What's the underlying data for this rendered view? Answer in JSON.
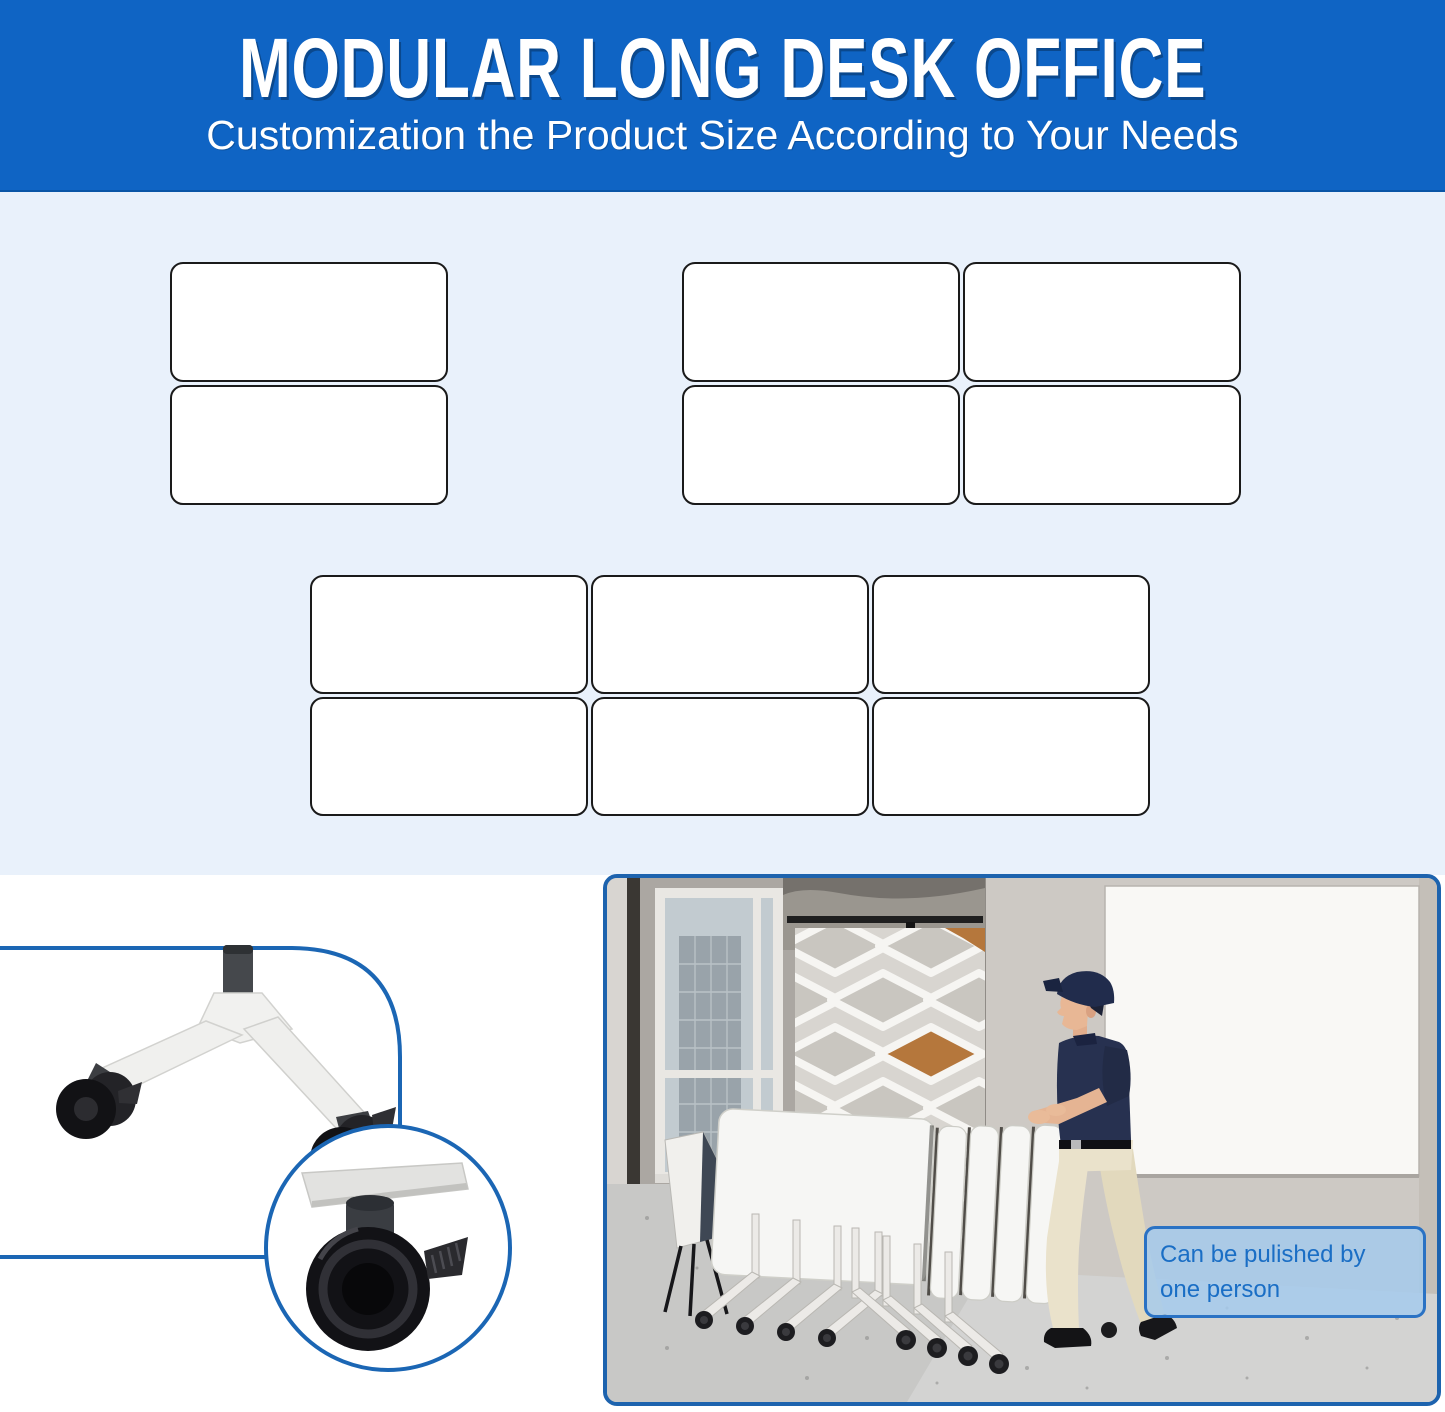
{
  "header": {
    "title": "MODULAR LONG DESK OFFICE",
    "subtitle": "Customization the Product Size According to Your Needs",
    "background_color": "#0f64c4",
    "text_color": "#ffffff"
  },
  "size_options": {
    "background_color": "#e9f1fb",
    "panel_fill": "#ffffff",
    "panel_border": "#1a1a1a",
    "groups": [
      {
        "name": "two-desk-layout",
        "rows": 2,
        "cols": 1
      },
      {
        "name": "four-desk-layout",
        "rows": 2,
        "cols": 2
      },
      {
        "name": "six-desk-layout",
        "rows": 2,
        "cols": 3
      }
    ]
  },
  "caster_detail": {
    "accent_color": "#1b66b4",
    "figures": [
      "desk-leg-with-casters",
      "caster-brake-closeup-callout"
    ]
  },
  "photo": {
    "border_color": "#1d63ae",
    "caption": "Can be pulished by one person",
    "caption_text_color": "#1a6ec5",
    "caption_fill": "#a4caee",
    "caption_border": "#2a72c4"
  }
}
